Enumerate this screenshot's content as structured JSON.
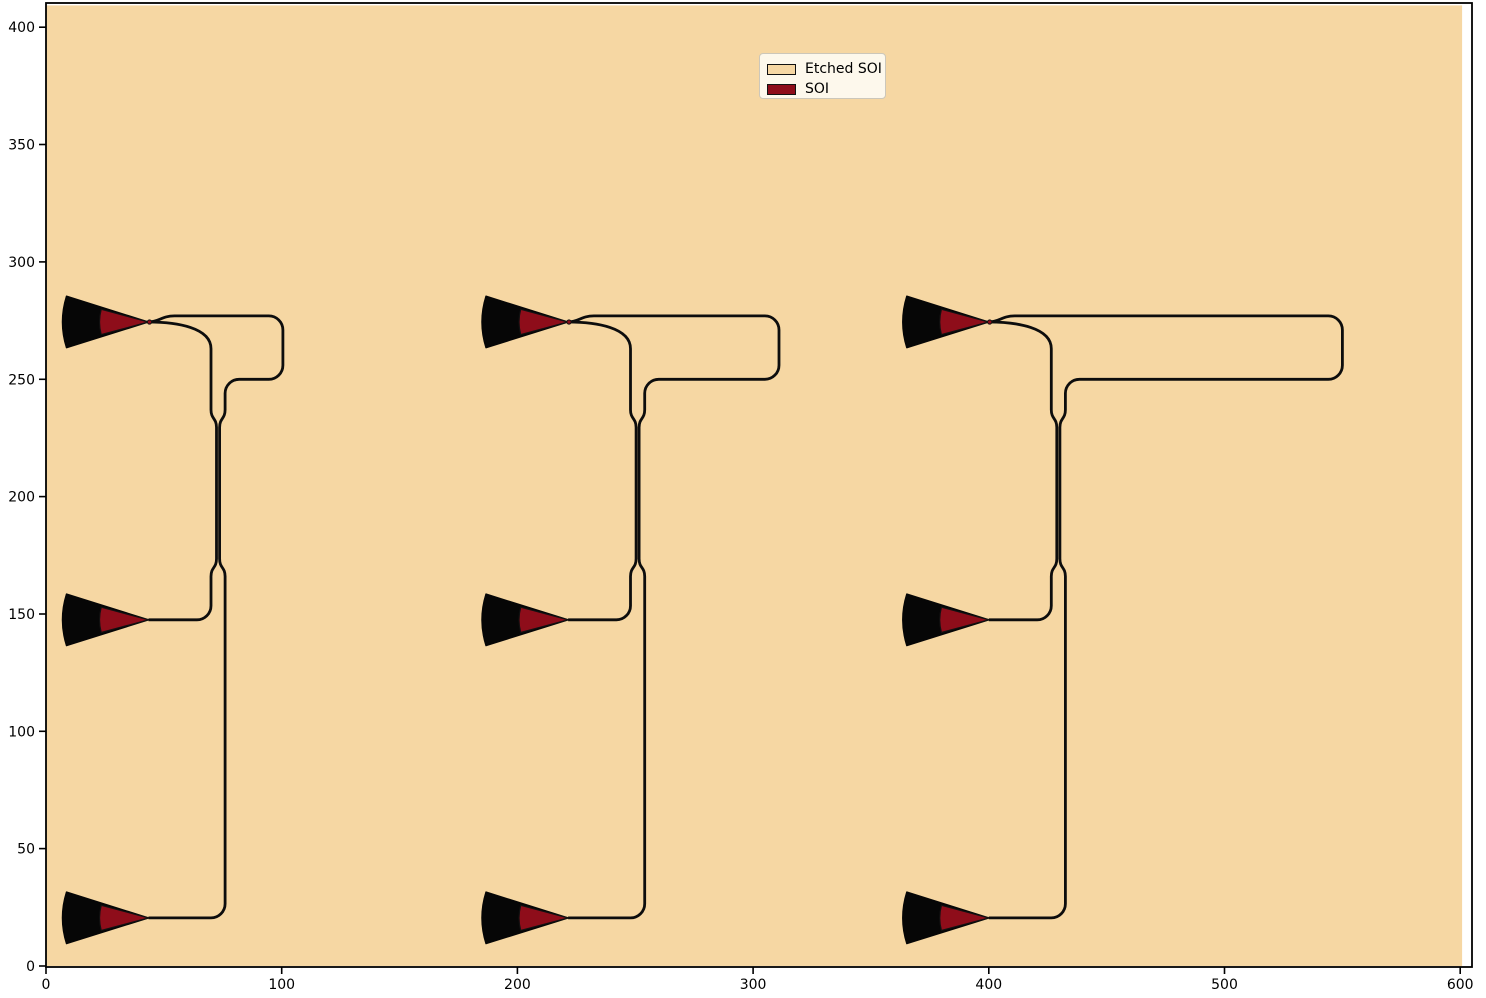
{
  "axes": {
    "x_ticks": [
      0,
      100,
      200,
      300,
      400,
      500,
      600
    ],
    "x_tick_labels": [
      "0",
      "100",
      "200",
      "300",
      "400",
      "500",
      "600"
    ],
    "y_ticks": [
      0,
      50,
      100,
      150,
      200,
      250,
      300,
      350,
      400
    ],
    "y_tick_labels": [
      "0",
      "50",
      "100",
      "150",
      "200",
      "250",
      "300",
      "350",
      "400"
    ],
    "xlim": [
      0,
      605
    ],
    "ylim": [
      0,
      411
    ],
    "spine_color": "#000000"
  },
  "legend": {
    "items": [
      {
        "label": "Etched SOI",
        "color": "#f6d7a3"
      },
      {
        "label": "SOI",
        "color": "#8e0d1a"
      }
    ],
    "background": "#fdf8ec",
    "border": "#ccc7ba"
  },
  "chart_data": {
    "type": "layout",
    "title": "",
    "xlabel": "",
    "ylabel": "",
    "grid": false,
    "legend_position": "upper center",
    "description": "Photonic chip layout plot: three directional-coupler test circuits. Each circuit has three fan-shaped fiber grating couplers (vertical pitch 127) joined by single-mode waveguides; the top coupler feeds a Y-split whose outer arm loops right before both arms run down into a vertical directional coupler whose outputs route to the middle and bottom couplers. Tan background rectangle is the Etched SOI layer; dark red wedges are the SOI layer.",
    "colors": {
      "etched_soi_fill": "#f6d7a3",
      "soi_fill": "#8e0d1a",
      "device_outline": "#0d0d0d",
      "figure_background": "#ffffff"
    },
    "etched_region": {
      "x0": 0,
      "y0": 0,
      "x1": 600.8,
      "y1": 409.3
    },
    "gc_rows_y": [
      274.4,
      147.5,
      20.5
    ],
    "structures": [
      {
        "tip_x": 43.5,
        "loop_right_x": 100.5
      },
      {
        "tip_x": 221.5,
        "loop_right_x": 311.0
      },
      {
        "tip_x": 400.0,
        "loop_right_x": 550.0
      }
    ],
    "geometry": {
      "grating_coupler": {
        "radius": 36.5,
        "inner_radius": 20.8,
        "half_angle_deg": 17.5,
        "inner_half_angle_deg": 15,
        "tip_dot_radius_px": 2.1
      },
      "bend_radius": 6,
      "wg_offsets": {
        "inner": 26.5,
        "outer": 32.5
      },
      "coupler": {
        "center_offset": 29.5,
        "half_gap": 0.65,
        "y_approach_top": 237,
        "y_top": 229.5,
        "y_bottom": 173.5,
        "y_release_bottom": 166
      },
      "levels": {
        "top_wg_y": 277.0,
        "loop_top_drop_y": 271.0,
        "loop_bottom_stop_y": 256.0,
        "return_wg_y": 250.0,
        "return_drop_y": 244.0,
        "mid_bend_start_y": 153.5,
        "mid_row_y": 147.5,
        "bottom_bend_start_y": 26.5,
        "bottom_row_y": 20.5
      },
      "wg_stroke_px": 2.8
    }
  }
}
